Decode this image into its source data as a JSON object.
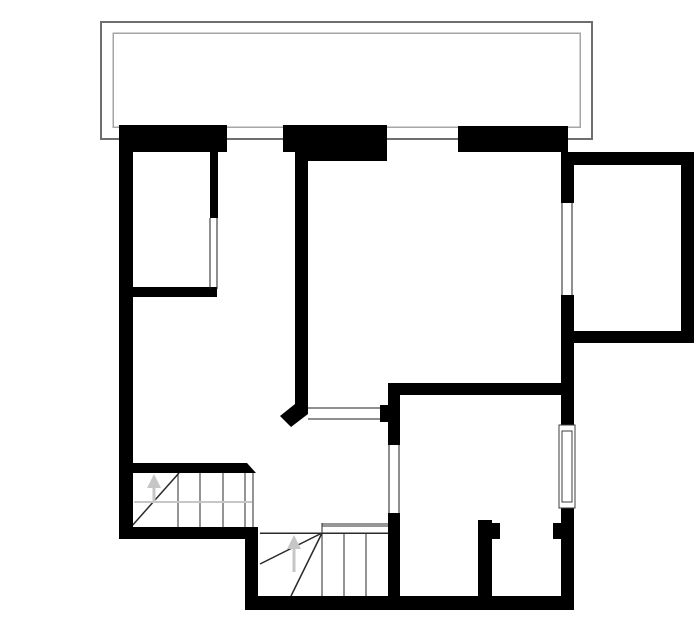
{
  "plan": {
    "canvas": {
      "width": 700,
      "height": 644,
      "background": "#ffffff"
    },
    "colors": {
      "wall": "#000000",
      "line": "#1f1f1f",
      "stair": "#2a2a2a",
      "guide": "#c6c6c6",
      "stringer": "#969696",
      "balconyOuter": "#6e6e6e",
      "balconyInner": "#a6a6a6",
      "frame": "#3c3c3c",
      "white": "#ffffff"
    },
    "shapes": [
      {
        "type": "orect",
        "name": "balcony-outer-outline",
        "x": 101,
        "y": 22,
        "w": 491,
        "h": 117,
        "color": "balconyOuter",
        "sw": 2
      },
      {
        "type": "orect",
        "name": "balcony-inner-outline",
        "x": 113,
        "y": 33,
        "w": 467,
        "h": 94,
        "color": "balconyInner",
        "sw": 1.5
      },
      {
        "type": "line",
        "name": "stair-upper-tread-1",
        "x1": 178,
        "y1": 473,
        "x2": 178,
        "y2": 527,
        "color": "stair",
        "sw": 1
      },
      {
        "type": "line",
        "name": "stair-upper-tread-2",
        "x1": 200,
        "y1": 473,
        "x2": 200,
        "y2": 527,
        "color": "stair",
        "sw": 1
      },
      {
        "type": "line",
        "name": "stair-upper-tread-3",
        "x1": 223,
        "y1": 473,
        "x2": 223,
        "y2": 527,
        "color": "stair",
        "sw": 1
      },
      {
        "type": "line",
        "name": "stair-upper-tread-4",
        "x1": 245,
        "y1": 473,
        "x2": 245,
        "y2": 527,
        "color": "stair",
        "sw": 1
      },
      {
        "type": "line",
        "name": "stair-upper-open-edge",
        "x1": 253,
        "y1": 473,
        "x2": 253,
        "y2": 527,
        "color": "stair",
        "sw": 1
      },
      {
        "type": "line",
        "name": "stair-upper-winder-line",
        "x1": 131,
        "y1": 527,
        "x2": 179,
        "y2": 473,
        "color": "stair",
        "sw": 1.5
      },
      {
        "type": "line",
        "name": "stair-upper-walk-line",
        "x1": 134,
        "y1": 502,
        "x2": 252,
        "y2": 502,
        "color": "guide",
        "sw": 2
      },
      {
        "type": "line",
        "name": "stair-upper-arrow-shaft",
        "x1": 154,
        "y1": 487,
        "x2": 154,
        "y2": 502,
        "color": "guide",
        "sw": 3
      },
      {
        "type": "poly",
        "name": "stair-upper-arrow-head",
        "pts": [
          [
            154,
            474
          ],
          [
            147,
            488
          ],
          [
            161,
            488
          ]
        ],
        "color": "guide"
      },
      {
        "type": "rect",
        "name": "stair-lower-stringer",
        "x": 322,
        "y": 523,
        "w": 76,
        "h": 4,
        "color": "stringer"
      },
      {
        "type": "line",
        "name": "stair-lower-stringer-end",
        "x1": 322,
        "y1": 523,
        "x2": 322,
        "y2": 533,
        "color": "stair",
        "sw": 1
      },
      {
        "type": "line",
        "name": "stair-lower-top-edge",
        "x1": 260,
        "y1": 533,
        "x2": 398,
        "y2": 533,
        "color": "stair",
        "sw": 1.5
      },
      {
        "type": "line",
        "name": "stair-lower-tread-1",
        "x1": 322,
        "y1": 533,
        "x2": 322,
        "y2": 596,
        "color": "stair",
        "sw": 1
      },
      {
        "type": "line",
        "name": "stair-lower-tread-2",
        "x1": 344,
        "y1": 533,
        "x2": 344,
        "y2": 596,
        "color": "stair",
        "sw": 1
      },
      {
        "type": "line",
        "name": "stair-lower-tread-3",
        "x1": 366,
        "y1": 533,
        "x2": 366,
        "y2": 596,
        "color": "stair",
        "sw": 1
      },
      {
        "type": "line",
        "name": "stair-lower-winder-line-1",
        "x1": 322,
        "y1": 533,
        "x2": 260,
        "y2": 564,
        "color": "stair",
        "sw": 1.5
      },
      {
        "type": "line",
        "name": "stair-lower-winder-line-2",
        "x1": 322,
        "y1": 533,
        "x2": 291,
        "y2": 596,
        "color": "stair",
        "sw": 1.5
      },
      {
        "type": "line",
        "name": "stair-lower-arrow-shaft",
        "x1": 294,
        "y1": 548,
        "x2": 294,
        "y2": 572,
        "color": "guide",
        "sw": 3
      },
      {
        "type": "poly",
        "name": "stair-lower-arrow-head",
        "pts": [
          [
            294,
            535
          ],
          [
            287,
            549
          ],
          [
            301,
            549
          ]
        ],
        "color": "guide"
      },
      {
        "type": "line",
        "name": "pass-through-top-line",
        "x1": 308,
        "y1": 408,
        "x2": 381,
        "y2": 408,
        "color": "line",
        "sw": 1
      },
      {
        "type": "line",
        "name": "pass-through-bottom-line",
        "x1": 308,
        "y1": 419,
        "x2": 381,
        "y2": 419,
        "color": "line",
        "sw": 1
      },
      {
        "type": "rect",
        "name": "left-exterior-wall",
        "x": 119,
        "y": 125,
        "w": 14,
        "h": 413,
        "color": "wall"
      },
      {
        "type": "rect",
        "name": "top-wall-left",
        "x": 119,
        "y": 125,
        "w": 108,
        "h": 27,
        "color": "wall"
      },
      {
        "type": "rect",
        "name": "top-wall-mid",
        "x": 283,
        "y": 125,
        "w": 24,
        "h": 27,
        "color": "wall"
      },
      {
        "type": "rect",
        "name": "top-wall-mid-thick",
        "x": 307,
        "y": 125,
        "w": 80,
        "h": 36,
        "color": "wall"
      },
      {
        "type": "rect",
        "name": "top-wall-right",
        "x": 458,
        "y": 126,
        "w": 110,
        "h": 26,
        "color": "wall"
      },
      {
        "type": "rect",
        "name": "right-wall-upper",
        "x": 561,
        "y": 152,
        "w": 13,
        "h": 51,
        "color": "wall"
      },
      {
        "type": "rect",
        "name": "right-wall-mid",
        "x": 561,
        "y": 295,
        "w": 13,
        "h": 130,
        "color": "wall"
      },
      {
        "type": "rect",
        "name": "right-wall-lower",
        "x": 561,
        "y": 508,
        "w": 13,
        "h": 100,
        "color": "wall"
      },
      {
        "type": "rect",
        "name": "bay-top-wall",
        "x": 568,
        "y": 152,
        "w": 126,
        "h": 13,
        "color": "wall"
      },
      {
        "type": "rect",
        "name": "bay-right-wall",
        "x": 681,
        "y": 152,
        "w": 13,
        "h": 191,
        "color": "wall"
      },
      {
        "type": "rect",
        "name": "bay-bottom-wall",
        "x": 574,
        "y": 331,
        "w": 120,
        "h": 12,
        "color": "wall"
      },
      {
        "type": "rect",
        "name": "center-wall",
        "x": 295,
        "y": 151,
        "w": 13,
        "h": 254,
        "color": "wall"
      },
      {
        "type": "poly",
        "name": "center-wall-chamfer-end",
        "pts": [
          [
            295,
            400
          ],
          [
            308,
            400
          ],
          [
            308,
            414
          ],
          [
            291,
            427
          ],
          [
            280,
            416
          ],
          [
            295,
            404
          ]
        ],
        "color": "wall"
      },
      {
        "type": "rect",
        "name": "room1-partition-wall",
        "x": 210,
        "y": 152,
        "w": 8,
        "h": 66,
        "color": "wall"
      },
      {
        "type": "rect",
        "name": "room1-bottom-wall",
        "x": 119,
        "y": 287,
        "w": 98,
        "h": 10,
        "color": "wall"
      },
      {
        "type": "rect",
        "name": "stair-top-wall",
        "x": 133,
        "y": 463,
        "w": 114,
        "h": 10,
        "color": "wall"
      },
      {
        "type": "poly",
        "name": "stair-top-wall-angled-end",
        "pts": [
          [
            247,
            463
          ],
          [
            256,
            473
          ],
          [
            247,
            473
          ]
        ],
        "color": "wall"
      },
      {
        "type": "rect",
        "name": "bottom-left-exterior-wall",
        "x": 119,
        "y": 527,
        "w": 139,
        "h": 12,
        "color": "wall"
      },
      {
        "type": "rect",
        "name": "stairwell-wall",
        "x": 245,
        "y": 527,
        "w": 13,
        "h": 83,
        "color": "wall"
      },
      {
        "type": "rect",
        "name": "bottom-exterior-wall",
        "x": 245,
        "y": 596,
        "w": 329,
        "h": 14,
        "color": "wall"
      },
      {
        "type": "rect",
        "name": "room2-top-wall",
        "x": 388,
        "y": 383,
        "w": 185,
        "h": 12,
        "color": "wall"
      },
      {
        "type": "rect",
        "name": "room2-left-wall-upper",
        "x": 388,
        "y": 383,
        "w": 12,
        "h": 62,
        "color": "wall"
      },
      {
        "type": "rect",
        "name": "room2-left-wall-lower",
        "x": 388,
        "y": 513,
        "w": 12,
        "h": 85,
        "color": "wall"
      },
      {
        "type": "rect",
        "name": "pass-through-jamb-stub",
        "x": 380,
        "y": 405,
        "w": 8,
        "h": 17,
        "color": "wall"
      },
      {
        "type": "rect",
        "name": "closet-pier",
        "x": 478,
        "y": 520,
        "w": 14,
        "h": 80,
        "color": "wall"
      },
      {
        "type": "rect",
        "name": "closet-pier-stub",
        "x": 492,
        "y": 523,
        "w": 8,
        "h": 16,
        "color": "wall"
      },
      {
        "type": "rect",
        "name": "closet-right-wall-stub",
        "x": 553,
        "y": 523,
        "w": 8,
        "h": 16,
        "color": "wall"
      },
      {
        "type": "line",
        "name": "room1-door-jamb-left",
        "x1": 210,
        "y1": 218,
        "x2": 210,
        "y2": 289,
        "color": "line",
        "sw": 1
      },
      {
        "type": "line",
        "name": "room1-door-jamb-right",
        "x1": 217,
        "y1": 218,
        "x2": 217,
        "y2": 289,
        "color": "line",
        "sw": 1
      },
      {
        "type": "line",
        "name": "bay-opening-jamb-left",
        "x1": 562,
        "y1": 203,
        "x2": 562,
        "y2": 295,
        "color": "line",
        "sw": 1
      },
      {
        "type": "line",
        "name": "bay-opening-jamb-right",
        "x1": 572,
        "y1": 203,
        "x2": 572,
        "y2": 295,
        "color": "line",
        "sw": 1
      },
      {
        "type": "line",
        "name": "room2-door-jamb-left",
        "x1": 389,
        "y1": 445,
        "x2": 389,
        "y2": 513,
        "color": "line",
        "sw": 1
      },
      {
        "type": "line",
        "name": "room2-door-jamb-right",
        "x1": 399,
        "y1": 445,
        "x2": 399,
        "y2": 513,
        "color": "line",
        "sw": 1
      },
      {
        "type": "orect",
        "name": "right-window-frame-outer",
        "x": 559,
        "y": 425,
        "w": 16,
        "h": 83,
        "color": "frame",
        "fill": "white",
        "sw": 1
      },
      {
        "type": "orect",
        "name": "right-window-frame-inner",
        "x": 562,
        "y": 431,
        "w": 10,
        "h": 71,
        "color": "frame",
        "sw": 1
      }
    ]
  }
}
